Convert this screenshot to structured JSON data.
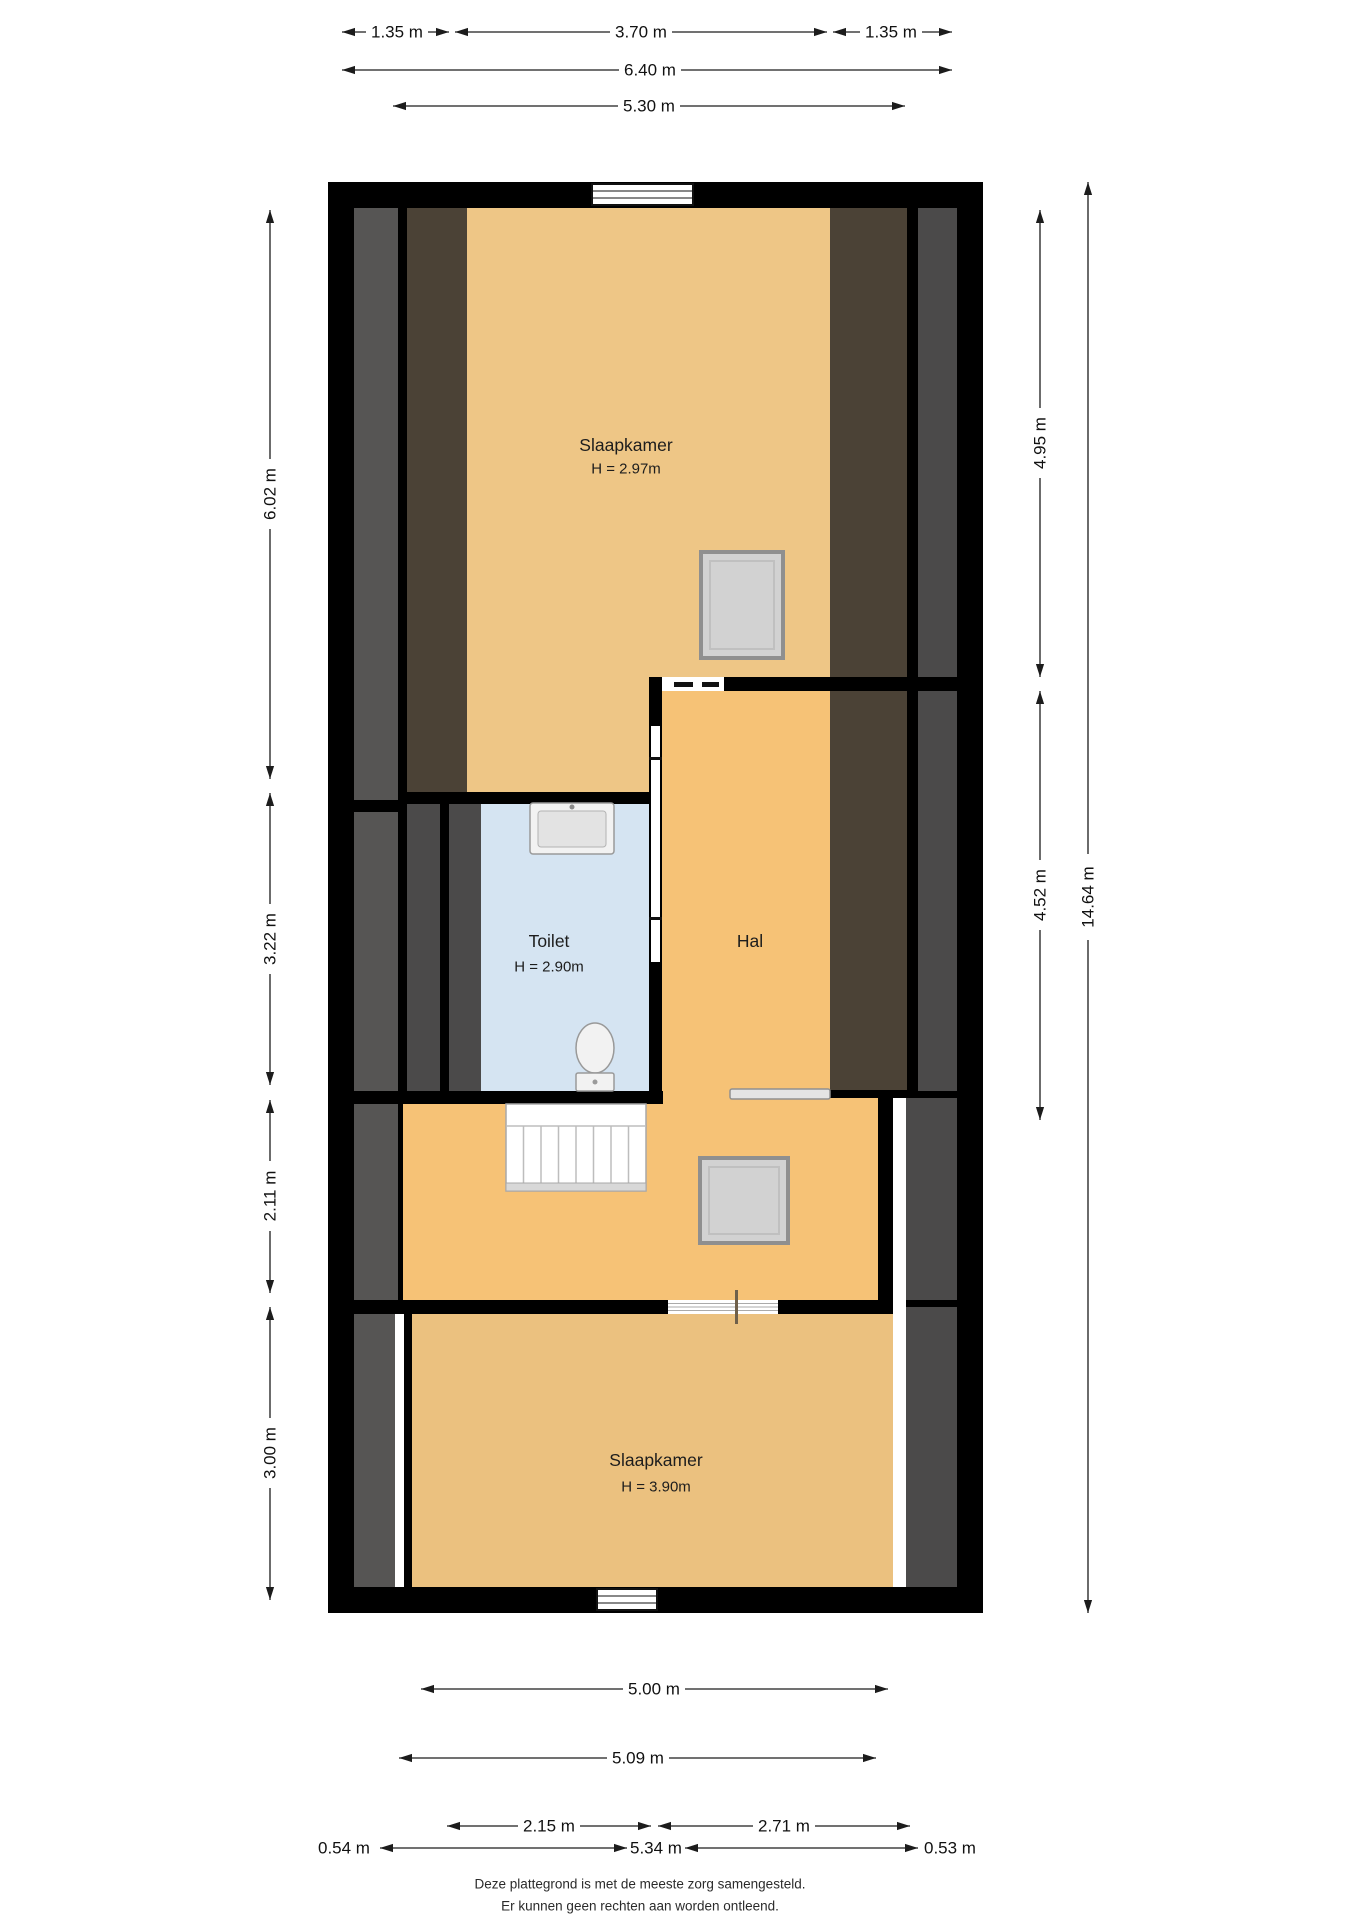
{
  "dimensions": {
    "top_row1": [
      "1.35 m",
      "3.70 m",
      "1.35 m"
    ],
    "top_row2": "6.40 m",
    "top_row3": "5.30 m",
    "left": [
      "6.02 m",
      "3.22 m",
      "2.11 m",
      "3.00 m"
    ],
    "right_inner": [
      "4.95 m",
      "4.52 m"
    ],
    "right_outer": "14.64 m",
    "bottom_row1": "5.00 m",
    "bottom_row2": "5.09 m",
    "bottom_row3": [
      "2.15 m",
      "2.71 m"
    ],
    "bottom_row4": [
      "0.54 m",
      "5.34 m",
      "0.53 m"
    ]
  },
  "rooms": {
    "bedroom_top": {
      "name": "Slaapkamer",
      "height": "H = 2.97m"
    },
    "toilet": {
      "name": "Toilet",
      "height": "H = 2.90m"
    },
    "hall": {
      "name": "Hal"
    },
    "bedroom_bottom": {
      "name": "Slaapkamer",
      "height": "H = 3.90m"
    }
  },
  "footer": {
    "line1": "Deze plattegrond is met de meeste zorg samengesteld.",
    "line2": "Er kunnen geen rechten aan worden ontleend."
  },
  "colors": {
    "wall": "#000000",
    "floor_bedroom_top": "#eec686",
    "floor_hall": "#f6c276",
    "floor_bedroom_bottom": "#ebc17f",
    "floor_toilet": "#d5e4f2",
    "slope_gray_left": "#565554",
    "slope_gray_right": "#4b4a4a",
    "slope_brown": "#4b4236"
  }
}
